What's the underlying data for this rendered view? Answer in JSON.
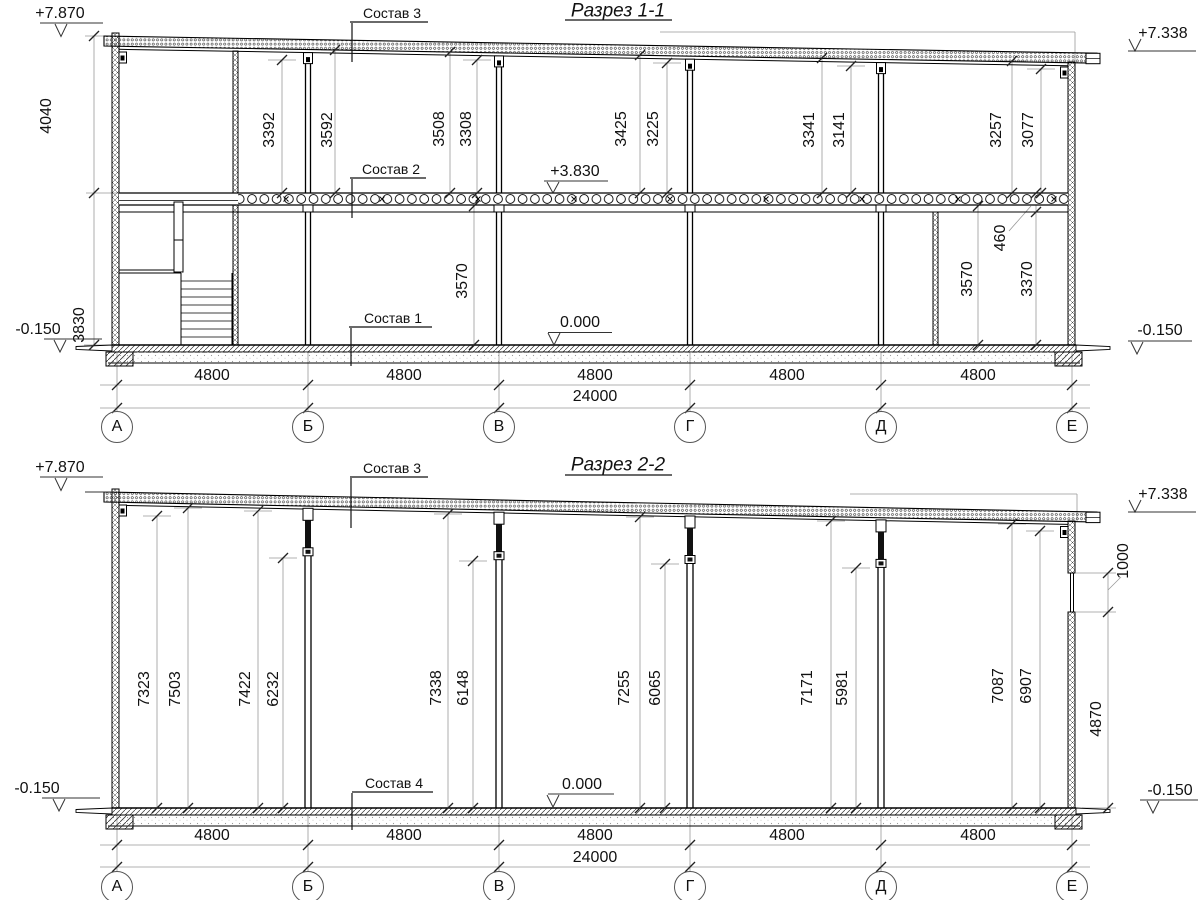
{
  "page": {
    "background": "#ffffff",
    "line_color": "#000000",
    "dim_line_color": "#999999"
  },
  "sections": {
    "s1": {
      "title": "Разрез 1-1",
      "labels": {
        "roof": "Состав 3",
        "floor2": "Состав 2",
        "floor1": "Состав 1"
      },
      "levels": {
        "top_left": "+7.870",
        "top_right": "+7.338",
        "slab": "+3.830",
        "zero": "0.000",
        "grade_left": "-0.150",
        "grade_right": "-0.150"
      },
      "side_dims": {
        "upper": "4040",
        "lower": "3830"
      },
      "height_dims": [
        "3392",
        "3592",
        "3508",
        "3308",
        "3425",
        "3225",
        "3341",
        "3141",
        "3257",
        "3077"
      ],
      "floor_dims": {
        "bay_bv": "3570",
        "bay_de_left": "3570",
        "bay_de_right": "3370",
        "beam_depth": "460"
      },
      "bay_dims": [
        "4800",
        "4800",
        "4800",
        "4800",
        "4800"
      ],
      "total_dim": "24000",
      "axes": [
        "А",
        "Б",
        "В",
        "Г",
        "Д",
        "Е"
      ]
    },
    "s2": {
      "title": "Разрез 2-2",
      "labels": {
        "roof": "Состав 3",
        "floor": "Состав 4"
      },
      "levels": {
        "top_left": "+7.870",
        "top_right": "+7.338",
        "zero": "0.000",
        "grade_left": "-0.150",
        "grade_right": "-0.150"
      },
      "height_dims": [
        "7323",
        "7503",
        "7422",
        "6232",
        "7338",
        "6148",
        "7255",
        "6065",
        "7171",
        "5981",
        "7087",
        "6907"
      ],
      "right_dims": {
        "window": "1000",
        "below_window": "4870"
      },
      "bay_dims": [
        "4800",
        "4800",
        "4800",
        "4800",
        "4800"
      ],
      "total_dim": "24000",
      "axes": [
        "А",
        "Б",
        "В",
        "Г",
        "Д",
        "Е"
      ]
    }
  }
}
